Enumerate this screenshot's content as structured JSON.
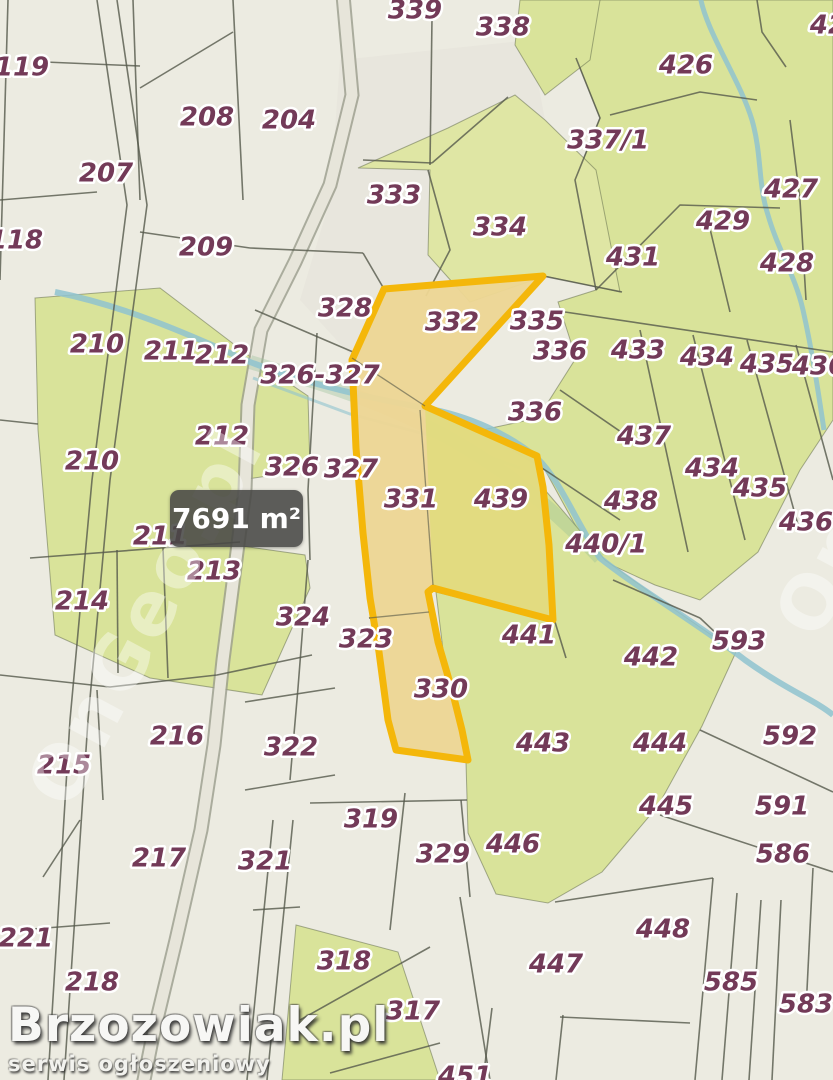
{
  "map": {
    "type": "cadastral-parcel-map",
    "area_label": {
      "text": "7691 m²"
    },
    "watermark": {
      "brand": "Brzozowiak.pl",
      "brand_subtitle": "serwis ogłoszeniowy",
      "tile": "OnGeo.pl"
    },
    "colors": {
      "base": "#ecebe1",
      "green": "#d9e39a",
      "green2": "#dfe6a4",
      "label": "#733a58",
      "highlight_stroke": "#f4b70a",
      "highlight_fill": "#edd9a2",
      "highlight_fill_green": "#dede8a",
      "stream": "#8fc3cf",
      "road_fill": "#e7e5da",
      "road_edge": "#9a9c8c",
      "boundary": "#55594b",
      "badge_bg": "#484846"
    },
    "highlighted_parcels": [
      "332",
      "331",
      "330",
      "439"
    ],
    "parcels": [
      {
        "label": "119",
        "x": 22,
        "y": 68
      },
      {
        "label": "208",
        "x": 207,
        "y": 118
      },
      {
        "label": "204",
        "x": 289,
        "y": 121
      },
      {
        "label": "207",
        "x": 106,
        "y": 174
      },
      {
        "label": "339",
        "x": 415,
        "y": 11
      },
      {
        "label": "338",
        "x": 503,
        "y": 28
      },
      {
        "label": "426",
        "x": 686,
        "y": 66
      },
      {
        "label": "42",
        "x": 828,
        "y": 26,
        "clipped": true
      },
      {
        "label": "337/1",
        "x": 608,
        "y": 141
      },
      {
        "label": "118",
        "x": 16,
        "y": 241
      },
      {
        "label": "209",
        "x": 206,
        "y": 248
      },
      {
        "label": "427",
        "x": 791,
        "y": 190
      },
      {
        "label": "429",
        "x": 723,
        "y": 222
      },
      {
        "label": "431",
        "x": 633,
        "y": 258
      },
      {
        "label": "428",
        "x": 787,
        "y": 264
      },
      {
        "label": "333",
        "x": 394,
        "y": 196
      },
      {
        "label": "334",
        "x": 500,
        "y": 228
      },
      {
        "label": "328",
        "x": 345,
        "y": 309
      },
      {
        "label": "332",
        "x": 452,
        "y": 323
      },
      {
        "label": "335",
        "x": 537,
        "y": 322
      },
      {
        "label": "336",
        "x": 560,
        "y": 352
      },
      {
        "label": "210",
        "x": 97,
        "y": 345
      },
      {
        "label": "211",
        "x": 171,
        "y": 352
      },
      {
        "label": "212",
        "x": 222,
        "y": 356
      },
      {
        "label": "326-327",
        "x": 320,
        "y": 376
      },
      {
        "label": "336",
        "x": 535,
        "y": 413
      },
      {
        "label": "433",
        "x": 638,
        "y": 351
      },
      {
        "label": "434",
        "x": 707,
        "y": 358
      },
      {
        "label": "435",
        "x": 767,
        "y": 365
      },
      {
        "label": "436",
        "x": 819,
        "y": 367
      },
      {
        "label": "212",
        "x": 222,
        "y": 437
      },
      {
        "label": "210",
        "x": 92,
        "y": 462
      },
      {
        "label": "326",
        "x": 292,
        "y": 468
      },
      {
        "label": "327",
        "x": 351,
        "y": 470
      },
      {
        "label": "437",
        "x": 644,
        "y": 437
      },
      {
        "label": "434",
        "x": 712,
        "y": 469
      },
      {
        "label": "331",
        "x": 411,
        "y": 500
      },
      {
        "label": "439",
        "x": 501,
        "y": 500
      },
      {
        "label": "435",
        "x": 760,
        "y": 489
      },
      {
        "label": "438",
        "x": 631,
        "y": 502
      },
      {
        "label": "436",
        "x": 806,
        "y": 523
      },
      {
        "label": "440/1",
        "x": 606,
        "y": 545
      },
      {
        "label": "211",
        "x": 160,
        "y": 537
      },
      {
        "label": "213",
        "x": 214,
        "y": 572
      },
      {
        "label": "214",
        "x": 82,
        "y": 602
      },
      {
        "label": "324",
        "x": 303,
        "y": 618
      },
      {
        "label": "323",
        "x": 366,
        "y": 640
      },
      {
        "label": "441",
        "x": 529,
        "y": 636
      },
      {
        "label": "442",
        "x": 651,
        "y": 658
      },
      {
        "label": "593",
        "x": 739,
        "y": 642
      },
      {
        "label": "216",
        "x": 177,
        "y": 737
      },
      {
        "label": "215",
        "x": 64,
        "y": 766
      },
      {
        "label": "322",
        "x": 291,
        "y": 748
      },
      {
        "label": "330",
        "x": 441,
        "y": 690
      },
      {
        "label": "443",
        "x": 543,
        "y": 744
      },
      {
        "label": "444",
        "x": 660,
        "y": 744
      },
      {
        "label": "592",
        "x": 790,
        "y": 737
      },
      {
        "label": "445",
        "x": 666,
        "y": 807
      },
      {
        "label": "591",
        "x": 782,
        "y": 807
      },
      {
        "label": "586",
        "x": 783,
        "y": 855
      },
      {
        "label": "217",
        "x": 159,
        "y": 859
      },
      {
        "label": "321",
        "x": 265,
        "y": 862
      },
      {
        "label": "319",
        "x": 371,
        "y": 820
      },
      {
        "label": "329",
        "x": 443,
        "y": 855
      },
      {
        "label": "446",
        "x": 513,
        "y": 845
      },
      {
        "label": "221",
        "x": 26,
        "y": 939
      },
      {
        "label": "218",
        "x": 92,
        "y": 983
      },
      {
        "label": "318",
        "x": 344,
        "y": 962
      },
      {
        "label": "317",
        "x": 413,
        "y": 1012
      },
      {
        "label": "447",
        "x": 556,
        "y": 965
      },
      {
        "label": "448",
        "x": 663,
        "y": 930
      },
      {
        "label": "585",
        "x": 731,
        "y": 983
      },
      {
        "label": "583",
        "x": 806,
        "y": 1005
      },
      {
        "label": "451",
        "x": 465,
        "y": 1077,
        "clipped": true
      }
    ]
  }
}
